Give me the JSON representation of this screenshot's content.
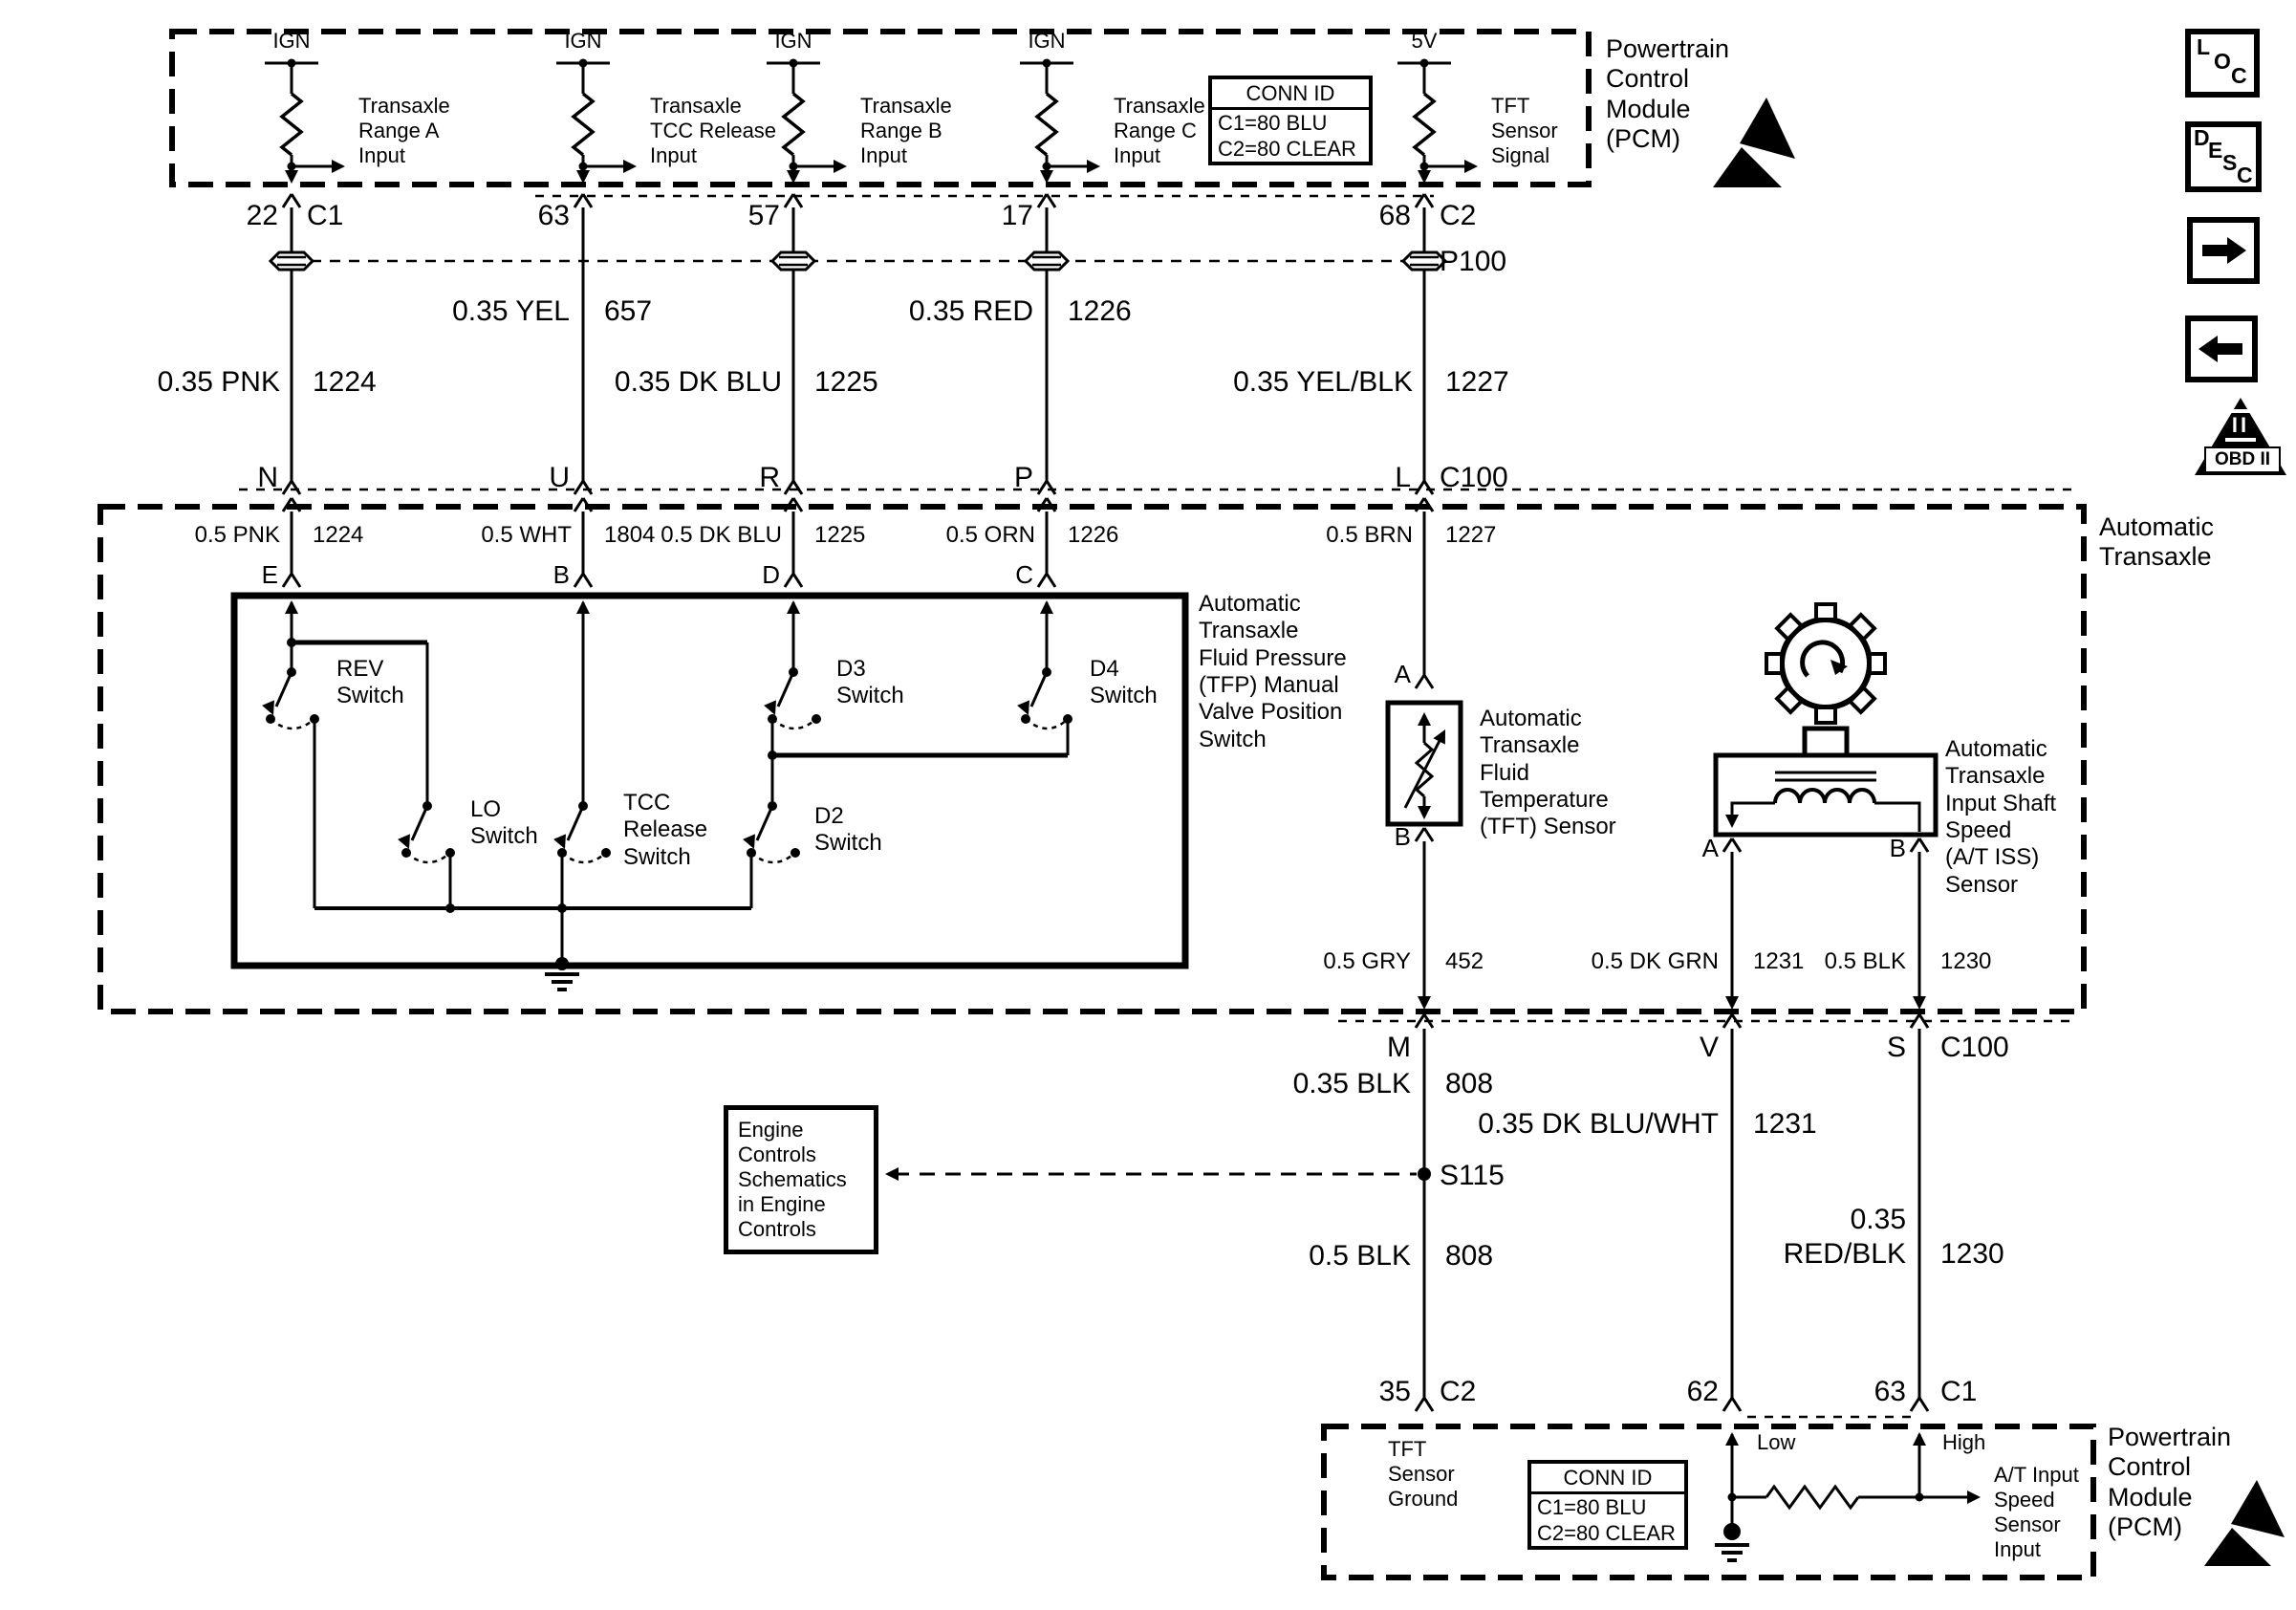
{
  "pcm_top": {
    "title": "Powertrain\nControl\nModule\n(PCM)",
    "conn_id": {
      "title": "CONN ID",
      "line1": "C1=80 BLU",
      "line2": "C2=80 CLEAR"
    },
    "columns": [
      {
        "supply": "IGN",
        "desc": "Transaxle\nRange A\nInput",
        "pin": "22",
        "conn": "C1"
      },
      {
        "supply": "IGN",
        "desc": "Transaxle\nTCC Release\nInput",
        "pin": "63",
        "conn": ""
      },
      {
        "supply": "IGN",
        "desc": "Transaxle\nRange B\nInput",
        "pin": "57",
        "conn": ""
      },
      {
        "supply": "IGN",
        "desc": "Transaxle\nRange C\nInput",
        "pin": "17",
        "conn": ""
      },
      {
        "supply": "5V",
        "desc": "TFT\nSensor\nSignal",
        "pin": "68",
        "conn": "C2"
      }
    ],
    "p100": "P100"
  },
  "harness_upper": {
    "w_yel": {
      "color": "0.35 YEL",
      "ckt": "657"
    },
    "w_red": {
      "color": "0.35 RED",
      "ckt": "1226"
    },
    "w_pnk": {
      "color": "0.35 PNK",
      "ckt": "1224"
    },
    "w_dkblu": {
      "color": "0.35 DK BLU",
      "ckt": "1225"
    },
    "w_yelblk": {
      "color": "0.35 YEL/BLK",
      "ckt": "1227"
    }
  },
  "c100_top": {
    "pins": [
      "N",
      "U",
      "R",
      "P",
      "L"
    ],
    "name": "C100"
  },
  "transaxle": {
    "title": "Automatic\nTransaxle",
    "wires": [
      {
        "color": "0.5 PNK",
        "ckt": "1224",
        "pin": "E"
      },
      {
        "color": "0.5 WHT",
        "ckt": "1804",
        "pin": "B"
      },
      {
        "color": "0.5 DK BLU",
        "ckt": "1225",
        "pin": "D"
      },
      {
        "color": "0.5 ORN",
        "ckt": "1226",
        "pin": "C"
      }
    ],
    "tft_wire": {
      "color": "0.5 BRN",
      "ckt": "1227"
    },
    "tfp": {
      "label": "Automatic\nTransaxle\nFluid Pressure\n(TFP) Manual\nValve Position\nSwitch",
      "rev": "REV\nSwitch",
      "lo": "LO\nSwitch",
      "tcc": "TCC\nRelease\nSwitch",
      "d2": "D2\nSwitch",
      "d3": "D3\nSwitch",
      "d4": "D4\nSwitch"
    },
    "tft": {
      "label": "Automatic\nTransaxle\nFluid\nTemperature\n(TFT) Sensor",
      "pin_a": "A",
      "pin_b": "B"
    },
    "iss": {
      "label": "Automatic\nTransaxle\nInput Shaft\nSpeed\n(A/T ISS)\nSensor",
      "pin_a": "A",
      "pin_b": "B"
    },
    "out_gry": {
      "color": "0.5 GRY",
      "ckt": "452"
    },
    "out_dkgrn": {
      "color": "0.5 DK GRN",
      "ckt": "1231"
    },
    "out_blk": {
      "color": "0.5 BLK",
      "ckt": "1230"
    }
  },
  "c100_bottom": {
    "pins": [
      "M",
      "V",
      "S"
    ],
    "name": "C100"
  },
  "harness_lower": {
    "w1": {
      "color": "0.35 BLK",
      "ckt": "808"
    },
    "w2": {
      "color": "0.35 DK BLU/WHT",
      "ckt": "1231"
    },
    "splice": "S115",
    "ref_box": "Engine\nControls\nSchematics\nin Engine\nControls",
    "w3": {
      "color": "0.5 BLK",
      "ckt": "808"
    },
    "w4": {
      "color": "0.35\nRED/BLK",
      "ckt": "1230"
    }
  },
  "pcm_bottom": {
    "title": "Powertrain\nControl\nModule\n(PCM)",
    "conn_id": {
      "title": "CONN ID",
      "line1": "C1=80 BLU",
      "line2": "C2=80 CLEAR"
    },
    "pin1": {
      "num": "35",
      "conn": "C2"
    },
    "pin2": {
      "num": "62",
      "conn": ""
    },
    "pin3": {
      "num": "63",
      "conn": "C1"
    },
    "tft_ground": "TFT\nSensor\nGround",
    "low": "Low",
    "high": "High",
    "speed_input": "A/T Input\nSpeed\nSensor\nInput"
  },
  "sidebar": {
    "loc": [
      "L",
      "O",
      "C"
    ],
    "desc": [
      "D",
      "E",
      "S",
      "C"
    ],
    "obd": {
      "numerals": "II",
      "label": "OBD II"
    }
  }
}
